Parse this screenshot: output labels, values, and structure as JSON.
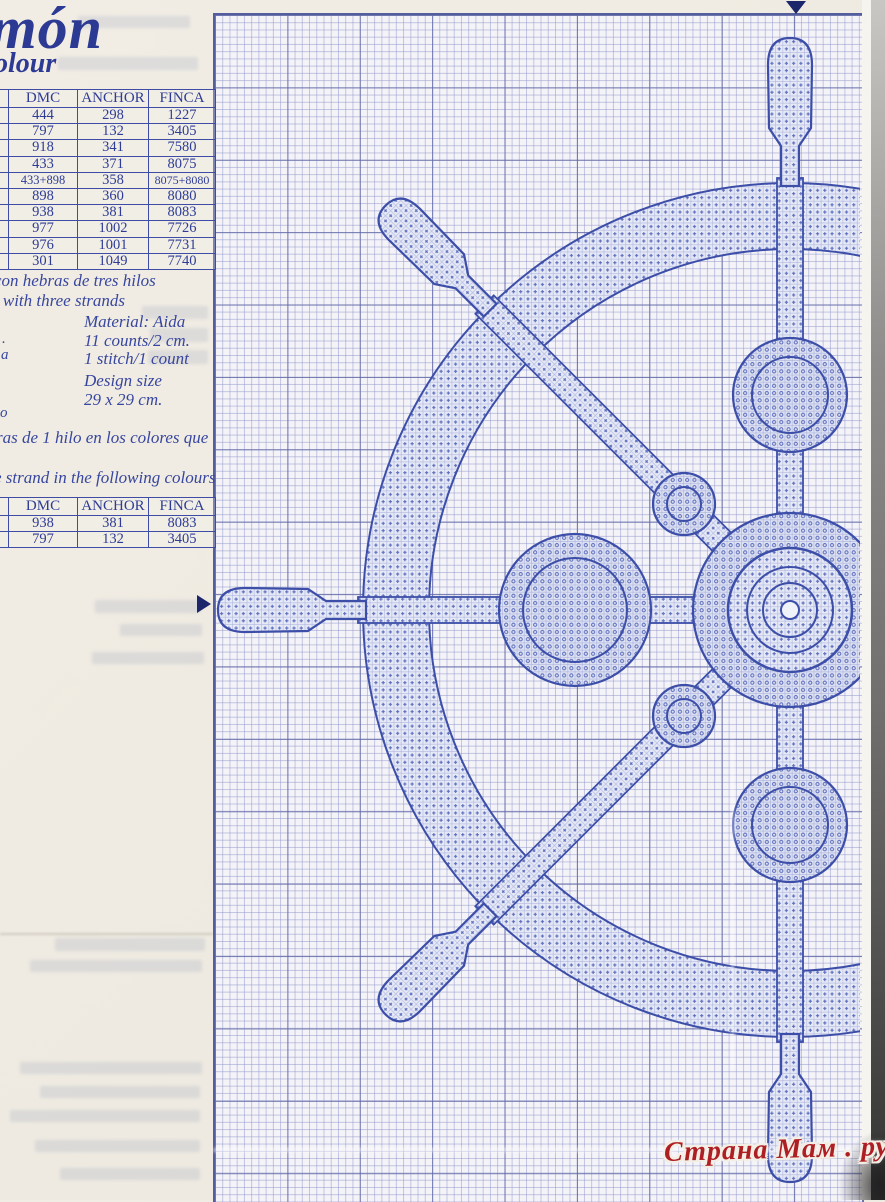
{
  "page": {
    "title_fragment": "món",
    "heading_fragment": "olour",
    "watermark_text": "Страна Мам . ру"
  },
  "colors": {
    "ink_blue": "#2e3c96",
    "pattern_blue": "#5b6cbc",
    "grid_major": "#6068a5",
    "grid_minor": "#8d93c8",
    "watermark_red": "#ae1f24",
    "paper": "#efebe2"
  },
  "key_table": {
    "headers": [
      "DMC",
      "ANCHOR",
      "FINCA"
    ],
    "rows": [
      [
        "444",
        "298",
        "1227"
      ],
      [
        "797",
        "132",
        "3405"
      ],
      [
        "918",
        "341",
        "7580"
      ],
      [
        "433",
        "371",
        "8075"
      ],
      [
        "433+898",
        "358",
        "8075+8080"
      ],
      [
        "898",
        "360",
        "8080"
      ],
      [
        "938",
        "381",
        "8083"
      ],
      [
        "977",
        "1002",
        "7726"
      ],
      [
        "976",
        "1001",
        "7731"
      ],
      [
        "301",
        "1049",
        "7740"
      ]
    ]
  },
  "instructions": {
    "spanish_fragment": "con hebras de tres hilos",
    "english_fragment": "s with three strands",
    "material_line": "Material: Aida",
    "count_line_1": "11 counts/2 cm.",
    "count_line_2": "1 stitch/1 count",
    "design_size_label": "Design size",
    "design_size_value": "29 x 29 cm.",
    "margin_fragment_1": ".",
    "margin_fragment_2": "a",
    "margin_fragment_3": "o",
    "backstitch_spanish_fragment": "ras de 1 hilo en los colores que",
    "backstitch_english_fragment": "e strand in the following colours"
  },
  "backstitch_table": {
    "headers": [
      "DMC",
      "ANCHOR",
      "FINCA"
    ],
    "rows": [
      [
        "938",
        "381",
        "8083"
      ],
      [
        "797",
        "132",
        "3405"
      ]
    ]
  },
  "chart": {
    "subject": "ship-wheel cross-stitch chart",
    "top_center_marker": "▼",
    "left_center_marker": "►"
  }
}
